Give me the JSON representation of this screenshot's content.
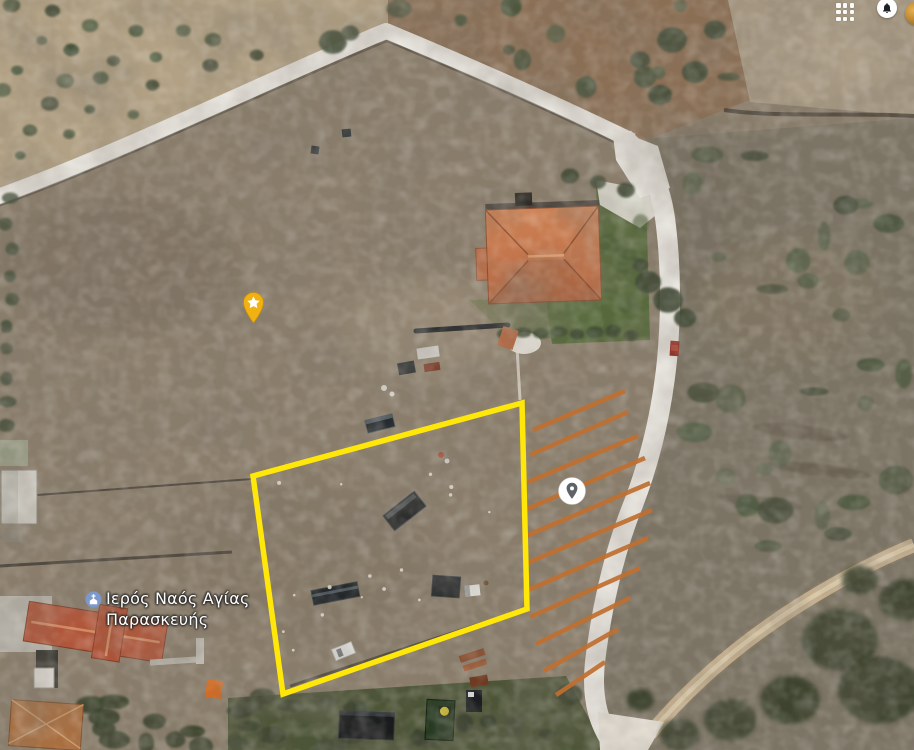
{
  "topbar": {
    "icons": [
      {
        "id": "apps",
        "name": "apps-grid-icon"
      },
      {
        "id": "notifications",
        "name": "notification-bell-icon"
      },
      {
        "id": "avatar",
        "name": "account-avatar"
      }
    ]
  },
  "map": {
    "view": "satellite",
    "poi": {
      "name": "church-poi",
      "label_line1": "Ιερός Ναός Αγίας",
      "label_line2": "Παρασκευής",
      "icon": "church-icon",
      "icon_color": "#7d99cc",
      "x": 85,
      "y": 588
    },
    "markers": {
      "starred_place": {
        "icon": "star-pin-icon",
        "color": "#f2b112",
        "x": 253,
        "y": 324
      },
      "dropped_pin": {
        "icon": "location-pin-icon",
        "color": "#ffffff",
        "pin_color": "#5f6368",
        "x": 572,
        "y": 491
      }
    },
    "parcel_outline": {
      "color": "#ffe70a",
      "stroke_width": 5.5,
      "vertices": [
        [
          253,
          476
        ],
        [
          522,
          403
        ],
        [
          527,
          609
        ],
        [
          283,
          694
        ]
      ]
    },
    "hatch": {
      "color": "#c06f30",
      "stroke_width": 4.5,
      "segments": [
        [
          533,
          430,
          625,
          391
        ],
        [
          530,
          455,
          628,
          412
        ],
        [
          528,
          482,
          638,
          436
        ],
        [
          527,
          509,
          645,
          458
        ],
        [
          526,
          536,
          650,
          483
        ],
        [
          527,
          563,
          652,
          510
        ],
        [
          528,
          590,
          648,
          538
        ],
        [
          530,
          617,
          640,
          568
        ],
        [
          536,
          644,
          630,
          598
        ],
        [
          544,
          671,
          618,
          629
        ],
        [
          556,
          695,
          605,
          662
        ]
      ]
    }
  }
}
